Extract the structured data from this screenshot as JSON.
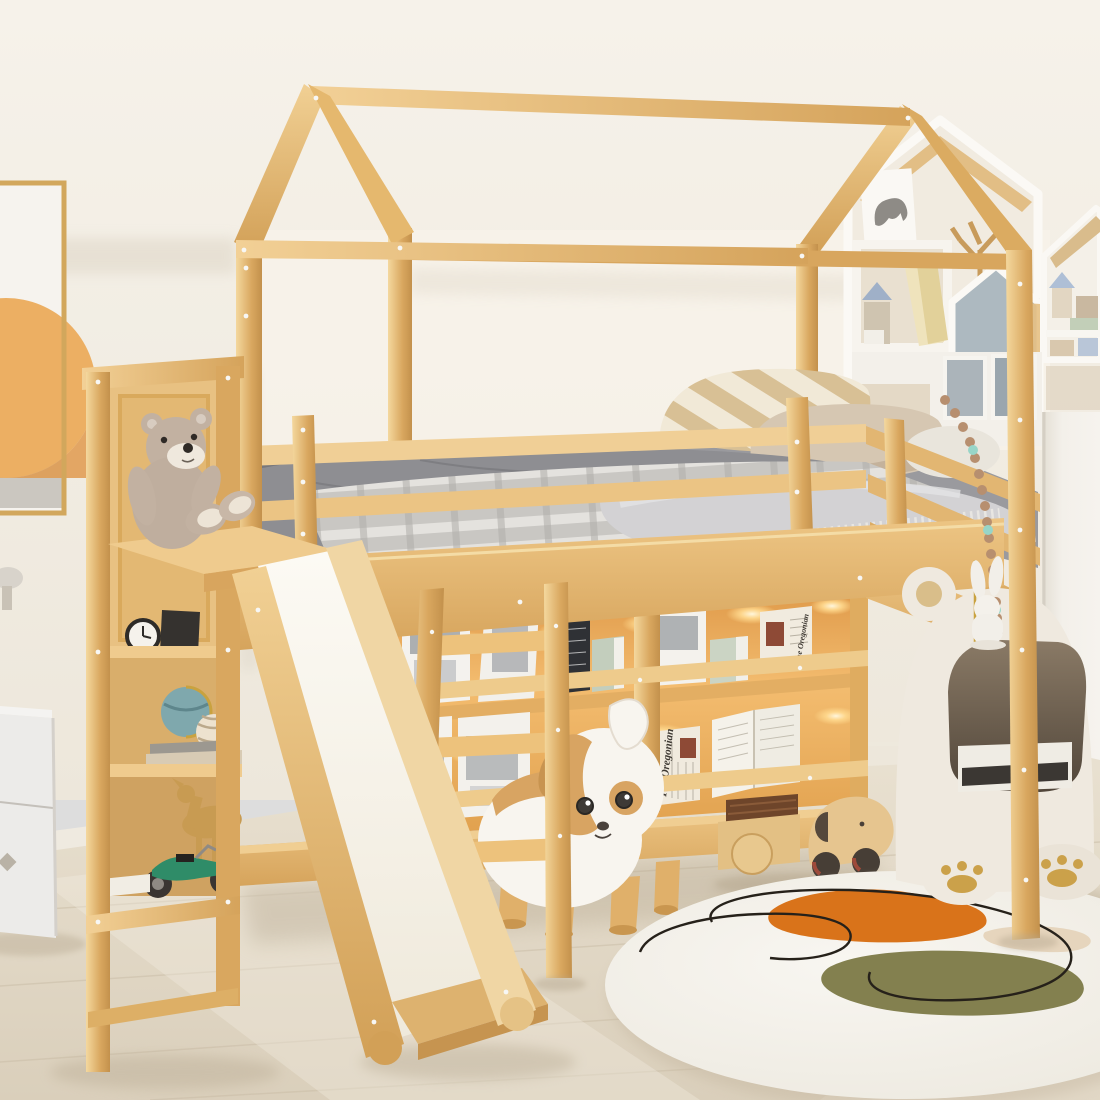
{
  "scene": {
    "description": "Kids bedroom with a natural wood house-shaped loft bed with slide, ladder, under-bed LED bookshelves, storage tower with teddy bear, puppy stool, bear side table and round abstract rug",
    "newspaper_title": "The Oregonian"
  },
  "palette": {
    "wall": "#F2EDE4",
    "floor": "#E0D6C3",
    "wood": "#E0B26A",
    "wood_light": "#F1D094",
    "wood_dark": "#C08E4A",
    "slide_surface": "#F8F4EB",
    "bedding_gray": "#96969A",
    "blanket_light": "#D7D5D1",
    "pillow_stripe": "#D8C095",
    "pillow_cream": "#F1E9D7",
    "led_glow": "#FFDE9E",
    "shelf_backlight": "#EDA14C",
    "rug_base": "#F5F2EC",
    "rug_orange": "#D9731A",
    "rug_olive": "#83804F",
    "rug_beige": "#E6D5BD",
    "rug_line": "#26211A",
    "dog_tan": "#D8A462",
    "dog_white": "#F8F5EF",
    "table_cream": "#EFE9DF",
    "poster_orange": "#ECAF63",
    "poster_orange_dark": "#E19A4E",
    "teddy_fur": "#C2B1A1",
    "motorcycle_green": "#2F8C68",
    "globe_teal": "#7FA8AD",
    "deer_gold": "#C89B52",
    "wardrobe_white": "#F1EEE7",
    "cabinet_gray": "#ECEBE9"
  }
}
